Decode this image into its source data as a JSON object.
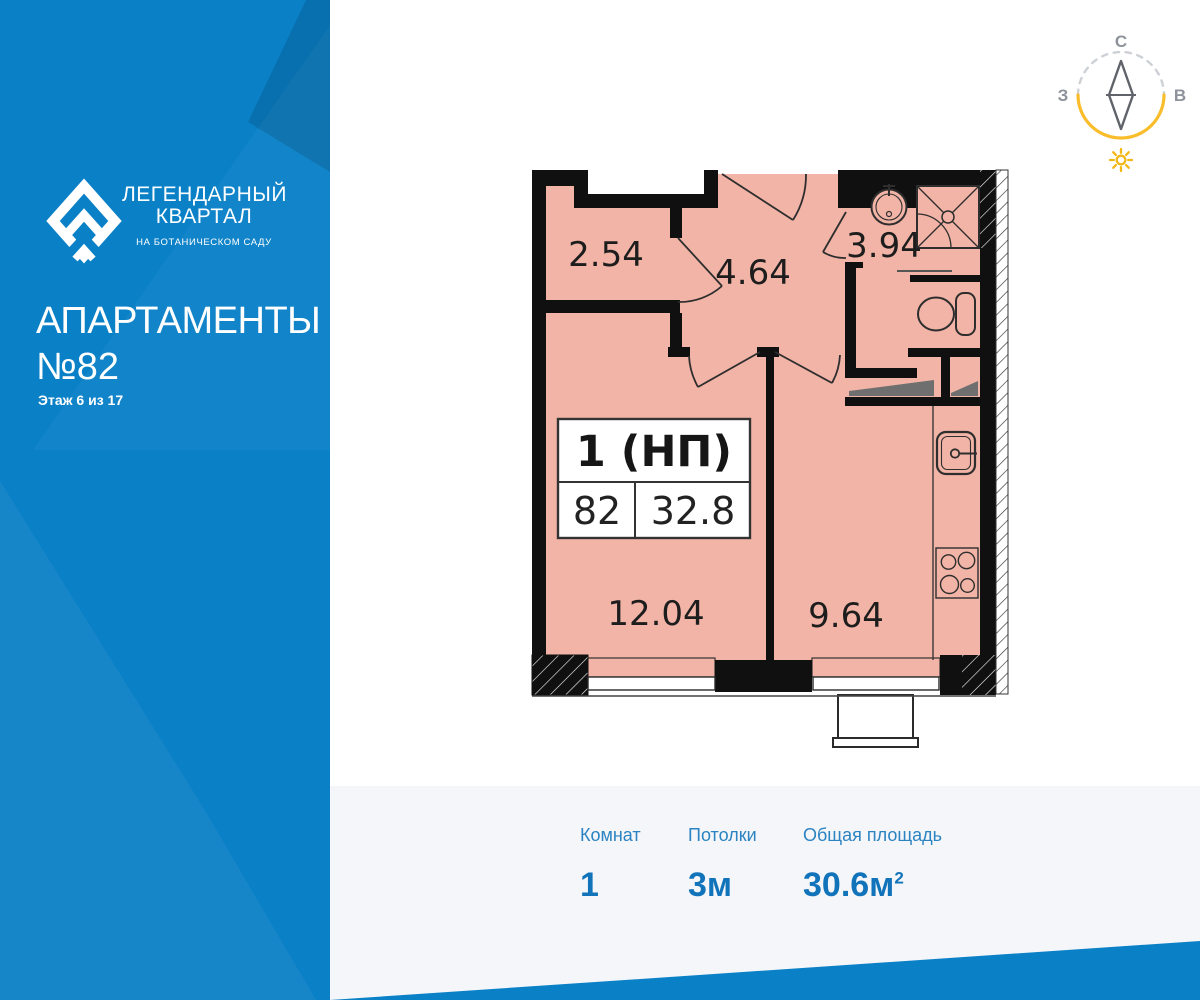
{
  "brand": {
    "logo_line1": "ЛЕГЕНДАРНЫЙ",
    "logo_line2": "КВАРТАЛ",
    "logo_tagline": "НА БОТАНИЧЕСКОМ САДУ"
  },
  "sidebar": {
    "title_line1": "АПАРТАМЕНТЫ",
    "title_line2": "№82",
    "floor_label": "Этаж 6 из 17",
    "bg_color": "#0A80C7"
  },
  "compass": {
    "north_label": "С",
    "west_label": "З",
    "east_label": "В",
    "arc_color": "#F9BD2B",
    "needle_color": "#60646A",
    "sun_color": "#F2B719"
  },
  "plan": {
    "wall_color": "#101010",
    "floor_color": "#F2B4A6",
    "rooms": [
      {
        "id": "hall-closet",
        "area": "2.54"
      },
      {
        "id": "entrance-hall",
        "area": "4.64"
      },
      {
        "id": "bathroom",
        "area": "3.94"
      },
      {
        "id": "living-room",
        "area": "12.04"
      },
      {
        "id": "kitchen",
        "area": "9.64"
      }
    ],
    "info_box": {
      "type_label": "1 (НП)",
      "apartment_number": "82",
      "total_area": "32.8"
    }
  },
  "stats": {
    "bg_color": "#F4F6F9",
    "items": [
      {
        "label": "Комнат",
        "value": "1",
        "sup": ""
      },
      {
        "label": "Потолки",
        "value": "3м",
        "sup": ""
      },
      {
        "label": "Общая площадь",
        "value": "30.6м",
        "sup": "2"
      }
    ]
  }
}
